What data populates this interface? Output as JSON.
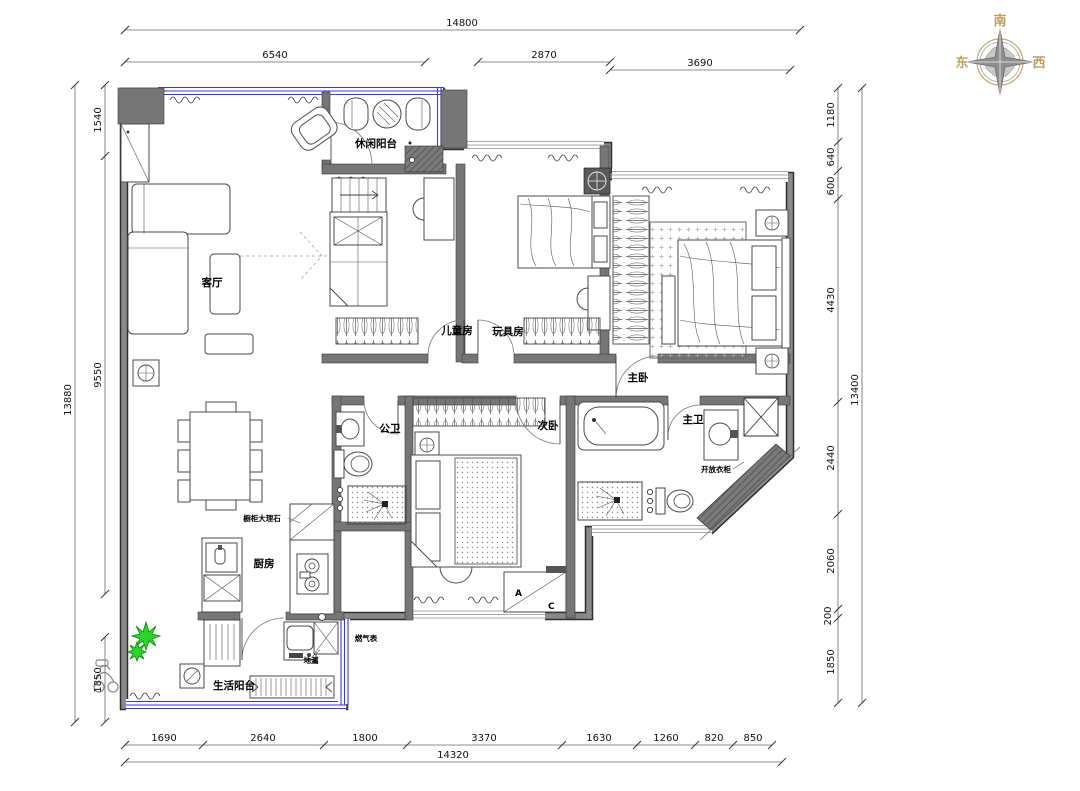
{
  "compass": {
    "top": "南",
    "left": "东",
    "right": "西"
  },
  "rooms": {
    "leisure_balcony": "休闲阳台",
    "living": "客厅",
    "kids_room": "儿童房",
    "toy_room": "玩具房",
    "master_bedroom": "主卧",
    "second_bedroom": "次卧",
    "public_bathroom": "公卫",
    "master_bathroom": "主卫",
    "kitchen": "厨房",
    "service_balcony": "生活阳台"
  },
  "annotations": {
    "gas_meter": "燃气表",
    "floor_drain": "地漏",
    "open_wardrobe": "开放衣柜",
    "cabinet_marble": "橱柜大理石",
    "ac_letter_a": "A",
    "ac_letter_c": "C"
  },
  "dimensions": {
    "top": {
      "overall": "14800",
      "segments": [
        "6540",
        "2870",
        "3690"
      ]
    },
    "bottom": {
      "overall": "14320",
      "segments": [
        "1690",
        "2640",
        "1800",
        "3370",
        "1630",
        "1260",
        "820",
        "850"
      ]
    },
    "left": {
      "overall": "13880",
      "segments": [
        "1540",
        "9550",
        "1850"
      ]
    },
    "right": {
      "overall": "13400",
      "segments": [
        "1180",
        "640",
        "600",
        "4430",
        "2440",
        "2060",
        "200",
        "1850"
      ]
    }
  },
  "colors": {
    "wall": "#767676",
    "window": "#3a3ad6",
    "plant": "#2ed32e",
    "compass_text": "#bd9d62"
  }
}
